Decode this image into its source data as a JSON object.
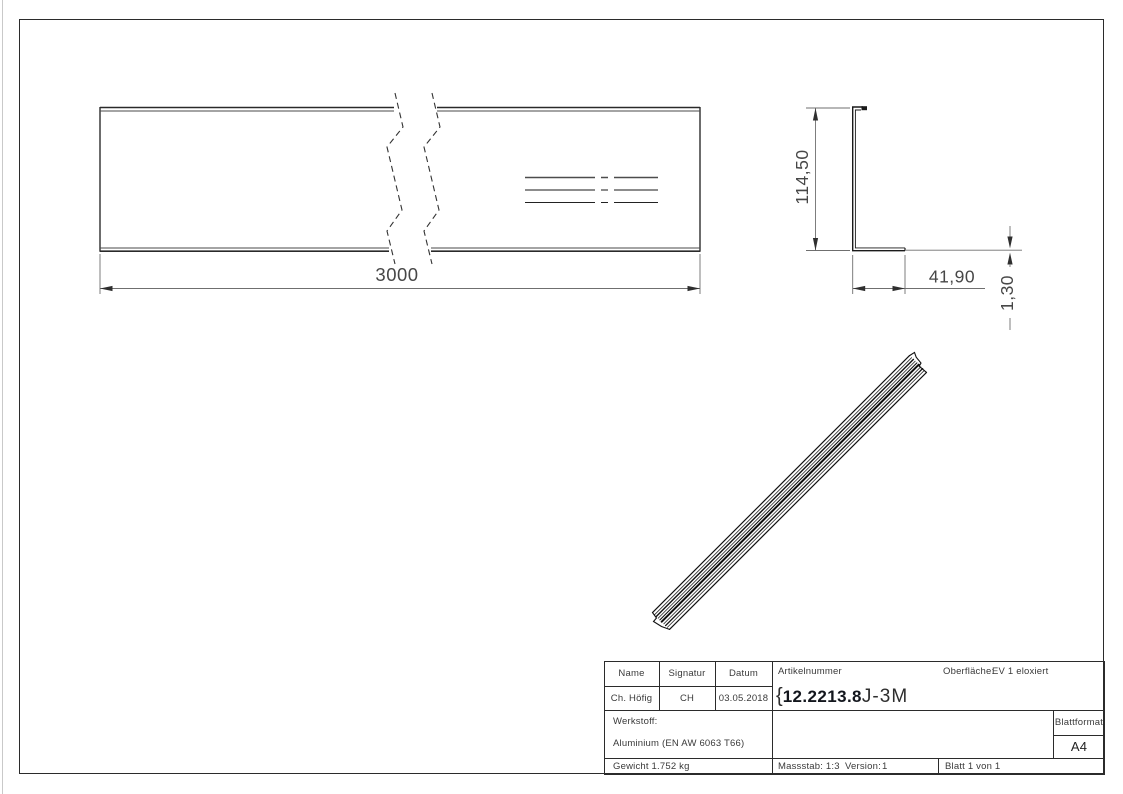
{
  "drawing": {
    "length_dim": "3000",
    "height_dim": "114,50",
    "width_dim": "41,90",
    "thickness_dim": "1,30"
  },
  "titleblock": {
    "headers": {
      "name": "Name",
      "signatur": "Signatur",
      "datum": "Datum"
    },
    "values": {
      "name": "Ch. Höfig",
      "signatur": "CH",
      "datum": "03.05.2018"
    },
    "artikelnummer_label": "Artikelnummer",
    "artikelnummer": {
      "prefix": "{",
      "main": "12.2213.8",
      "suffix": "J-3M"
    },
    "oberflaeche_label": "Oberfläche:",
    "oberflaeche_value": "EV 1 eloxiert",
    "werkstoff_label": "Werkstoff:",
    "werkstoff_value": "Aluminium (EN AW 6063 T66)",
    "gewicht": "Gewicht 1.752 kg",
    "massstab": "Massstab: 1:3",
    "version_label": "Version:",
    "version_value": "1",
    "blatt": "Blatt 1 von 1",
    "blattformat_label": "Blattformat",
    "blattformat_value": "A4"
  }
}
